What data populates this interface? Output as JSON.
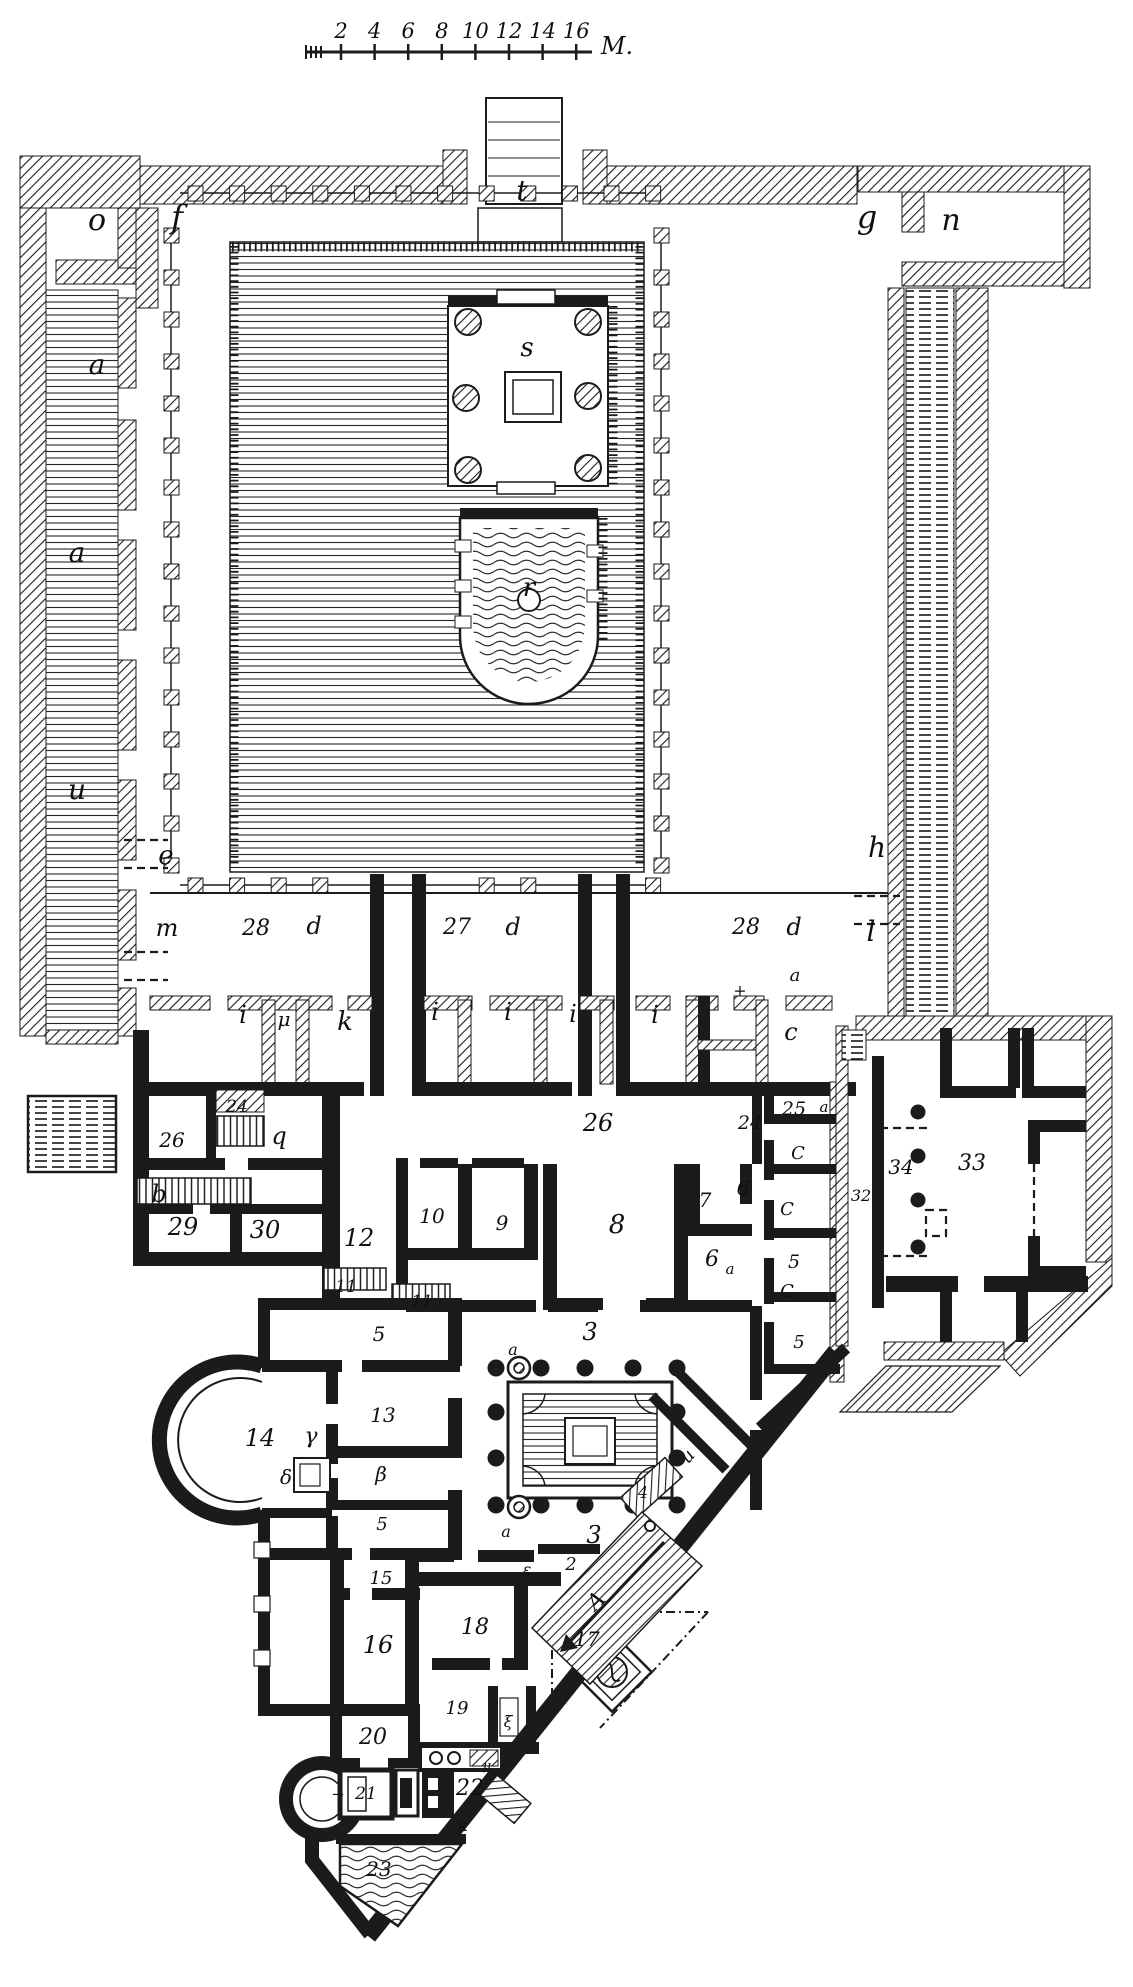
{
  "figure": {
    "kind": "engraved architectural floor plan",
    "ink_color": "#1b1b1b",
    "paper_color": "#ffffff"
  },
  "scalebar": {
    "tick_labels": [
      "2",
      "4",
      "6",
      "8",
      "10",
      "12",
      "14",
      "16"
    ],
    "unit_label": "M."
  },
  "plan": {
    "labels": [
      {
        "t": "t",
        "x": 522,
        "y": 200,
        "s": 28
      },
      {
        "t": "o",
        "x": 97,
        "y": 230,
        "s": 30
      },
      {
        "t": "f",
        "x": 177,
        "y": 228,
        "s": 32
      },
      {
        "t": "g",
        "x": 867,
        "y": 228,
        "s": 32
      },
      {
        "t": "n",
        "x": 951,
        "y": 230,
        "s": 30
      },
      {
        "t": "a",
        "x": 97,
        "y": 374,
        "s": 28
      },
      {
        "t": "a",
        "x": 77,
        "y": 562,
        "s": 28
      },
      {
        "t": "u",
        "x": 77,
        "y": 799,
        "s": 28
      },
      {
        "t": "s",
        "x": 527,
        "y": 356,
        "s": 26
      },
      {
        "t": "r",
        "x": 529,
        "y": 596,
        "s": 26
      },
      {
        "t": "e",
        "x": 166,
        "y": 864,
        "s": 26
      },
      {
        "t": "h",
        "x": 877,
        "y": 857,
        "s": 28
      },
      {
        "t": "m",
        "x": 167,
        "y": 936,
        "s": 24
      },
      {
        "t": "l",
        "x": 871,
        "y": 941,
        "s": 28
      },
      {
        "t": "28",
        "x": 256,
        "y": 935,
        "s": 22
      },
      {
        "t": "d",
        "x": 314,
        "y": 934,
        "s": 24
      },
      {
        "t": "27",
        "x": 457,
        "y": 934,
        "s": 22
      },
      {
        "t": "d",
        "x": 513,
        "y": 935,
        "s": 24
      },
      {
        "t": "28",
        "x": 746,
        "y": 934,
        "s": 22
      },
      {
        "t": "d",
        "x": 794,
        "y": 935,
        "s": 24
      },
      {
        "t": "a",
        "x": 795,
        "y": 981,
        "s": 18
      },
      {
        "t": "i",
        "x": 243,
        "y": 1023,
        "s": 24
      },
      {
        "t": "μ",
        "x": 284,
        "y": 1026,
        "s": 20
      },
      {
        "t": "k",
        "x": 345,
        "y": 1030,
        "s": 26
      },
      {
        "t": "i",
        "x": 435,
        "y": 1020,
        "s": 24
      },
      {
        "t": "i",
        "x": 508,
        "y": 1020,
        "s": 24
      },
      {
        "t": "i",
        "x": 573,
        "y": 1022,
        "s": 24
      },
      {
        "t": "i",
        "x": 655,
        "y": 1023,
        "s": 24
      },
      {
        "t": "+",
        "x": 740,
        "y": 996,
        "s": 16
      },
      {
        "t": "c",
        "x": 791,
        "y": 1040,
        "s": 24
      },
      {
        "t": "26",
        "x": 172,
        "y": 1147,
        "s": 20
      },
      {
        "t": "24",
        "x": 237,
        "y": 1112,
        "s": 17
      },
      {
        "t": "q",
        "x": 279,
        "y": 1144,
        "s": 24
      },
      {
        "t": "26",
        "x": 598,
        "y": 1131,
        "s": 24
      },
      {
        "t": "24",
        "x": 750,
        "y": 1129,
        "s": 19
      },
      {
        "t": "25",
        "x": 794,
        "y": 1115,
        "s": 19
      },
      {
        "t": "a",
        "x": 824,
        "y": 1112,
        "s": 15
      },
      {
        "t": "C",
        "x": 798,
        "y": 1159,
        "s": 18
      },
      {
        "t": "b",
        "x": 159,
        "y": 1202,
        "s": 24
      },
      {
        "t": "29",
        "x": 183,
        "y": 1235,
        "s": 24
      },
      {
        "t": "30",
        "x": 265,
        "y": 1238,
        "s": 24
      },
      {
        "t": "12",
        "x": 359,
        "y": 1246,
        "s": 24
      },
      {
        "t": "10",
        "x": 432,
        "y": 1223,
        "s": 20
      },
      {
        "t": "9",
        "x": 502,
        "y": 1230,
        "s": 20
      },
      {
        "t": "8",
        "x": 617,
        "y": 1233,
        "s": 26
      },
      {
        "t": "7",
        "x": 705,
        "y": 1207,
        "s": 20
      },
      {
        "t": "6",
        "x": 743,
        "y": 1195,
        "s": 20
      },
      {
        "t": "C",
        "x": 787,
        "y": 1215,
        "s": 18
      },
      {
        "t": "6",
        "x": 712,
        "y": 1266,
        "s": 22
      },
      {
        "t": "a",
        "x": 730,
        "y": 1274,
        "s": 15
      },
      {
        "t": "5",
        "x": 794,
        "y": 1268,
        "s": 19
      },
      {
        "t": "C",
        "x": 787,
        "y": 1297,
        "s": 18
      },
      {
        "t": "5",
        "x": 799,
        "y": 1348,
        "s": 18
      },
      {
        "t": "34",
        "x": 901,
        "y": 1174,
        "s": 20
      },
      {
        "t": "33",
        "x": 972,
        "y": 1170,
        "s": 22
      },
      {
        "t": "32",
        "x": 861,
        "y": 1201,
        "s": 16
      },
      {
        "t": "11",
        "x": 346,
        "y": 1292,
        "s": 17
      },
      {
        "t": "11",
        "x": 422,
        "y": 1307,
        "s": 17
      },
      {
        "t": "3",
        "x": 590,
        "y": 1340,
        "s": 24
      },
      {
        "t": "a",
        "x": 513,
        "y": 1355,
        "s": 16
      },
      {
        "t": "3",
        "x": 594,
        "y": 1543,
        "s": 24
      },
      {
        "t": "a",
        "x": 506,
        "y": 1537,
        "s": 16
      },
      {
        "t": "5",
        "x": 379,
        "y": 1341,
        "s": 20
      },
      {
        "t": "13",
        "x": 383,
        "y": 1422,
        "s": 20
      },
      {
        "t": "γ",
        "x": 311,
        "y": 1443,
        "s": 22
      },
      {
        "t": "14",
        "x": 260,
        "y": 1446,
        "s": 24
      },
      {
        "t": "δ",
        "x": 286,
        "y": 1484,
        "s": 20
      },
      {
        "t": "β",
        "x": 381,
        "y": 1481,
        "s": 20
      },
      {
        "t": "5",
        "x": 382,
        "y": 1530,
        "s": 18
      },
      {
        "t": "15",
        "x": 381,
        "y": 1584,
        "s": 18
      },
      {
        "t": "16",
        "x": 378,
        "y": 1653,
        "s": 24
      },
      {
        "t": "18",
        "x": 475,
        "y": 1634,
        "s": 22
      },
      {
        "t": "19",
        "x": 457,
        "y": 1714,
        "s": 18
      },
      {
        "t": "ξ",
        "x": 508,
        "y": 1727,
        "s": 16
      },
      {
        "t": "17",
        "x": 587,
        "y": 1646,
        "s": 20
      },
      {
        "t": "ε",
        "x": 527,
        "y": 1575,
        "s": 16
      },
      {
        "t": "2",
        "x": 571,
        "y": 1570,
        "s": 18
      },
      {
        "t": "u",
        "x": 692,
        "y": 1460,
        "s": 18,
        "r": -50
      },
      {
        "t": "4",
        "x": 643,
        "y": 1498,
        "s": 16
      },
      {
        "t": "A",
        "x": 601,
        "y": 1606,
        "s": 22,
        "r": -44
      },
      {
        "t": "→",
        "x": 338,
        "y": 1799,
        "s": 14
      },
      {
        "t": "20",
        "x": 373,
        "y": 1744,
        "s": 22
      },
      {
        "t": "21",
        "x": 366,
        "y": 1799,
        "s": 17
      },
      {
        "t": "22",
        "x": 470,
        "y": 1795,
        "s": 22
      },
      {
        "t": "κ",
        "x": 463,
        "y": 1831,
        "s": 16
      },
      {
        "t": "μ",
        "x": 487,
        "y": 1770,
        "s": 13
      },
      {
        "t": "23",
        "x": 379,
        "y": 1876,
        "s": 20
      }
    ]
  }
}
